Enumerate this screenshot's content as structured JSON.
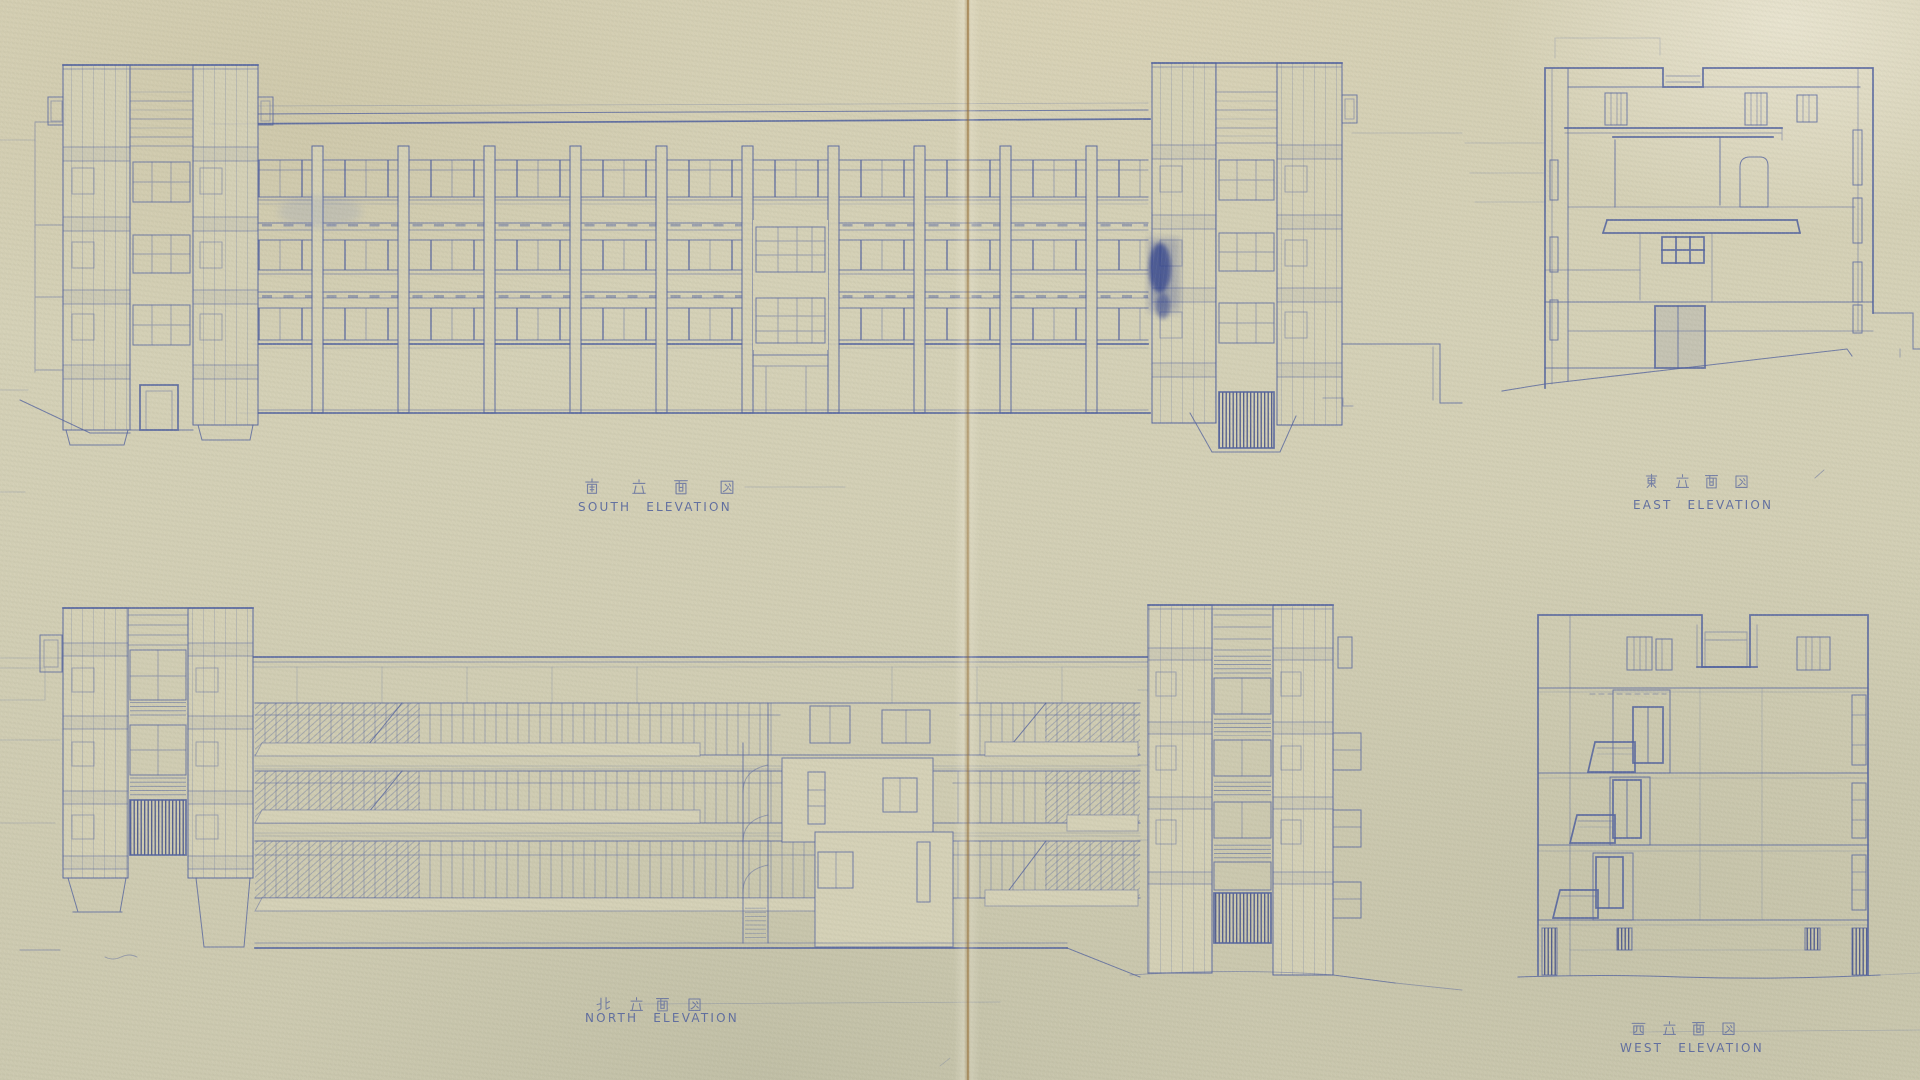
{
  "sheet": {
    "type": "architectural-elevation-blueprint",
    "labels": {
      "south": {
        "jp": "南 立 面 図",
        "en": "SOUTH ELEVATION"
      },
      "east": {
        "jp": "東 立 面 図",
        "en": "EAST ELEVATION"
      },
      "north": {
        "jp": "北 立 面 図",
        "en": "NORTH ELEVATION"
      },
      "west": {
        "jp": "西 立 面 図",
        "en": "WEST ELEVATION"
      }
    },
    "colors": {
      "paper": "#d5d1b7",
      "ink": "#53639f",
      "ink-faint": "#8a93bb",
      "ink-dark": "#2e3d85",
      "crease": "#a8895a"
    }
  }
}
